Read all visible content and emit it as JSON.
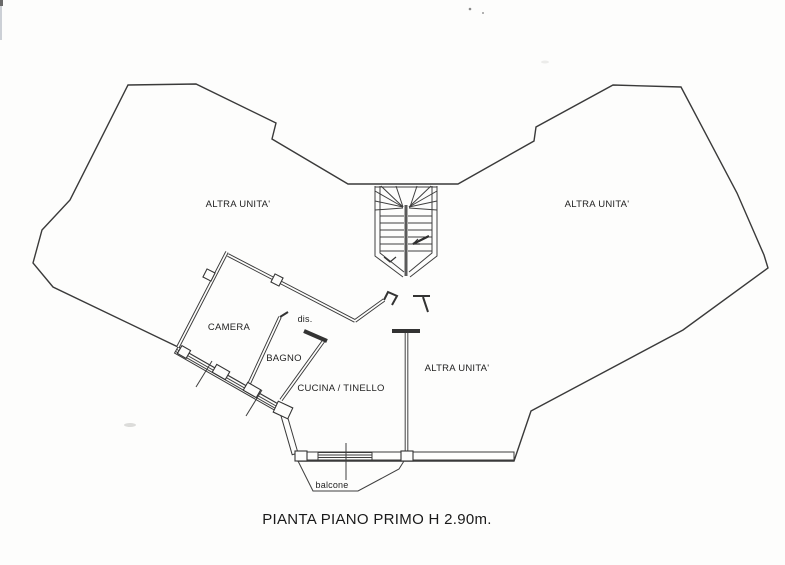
{
  "colors": {
    "ink": "#3a3a3a",
    "paper": "#fdfdfc"
  },
  "plan": {
    "rooms": {
      "altra_unita_left": "ALTRA UNITA'",
      "altra_unita_right": "ALTRA UNITA'",
      "altra_unita_bottom": "ALTRA UNITA'",
      "camera": "CAMERA",
      "bagno": "BAGNO",
      "disimpegno": "dis.",
      "cucina_tinello": "CUCINA / TINELLO",
      "balcone": "balcone"
    },
    "caption": "PIANTA PIANO PRIMO H 2.90m."
  }
}
